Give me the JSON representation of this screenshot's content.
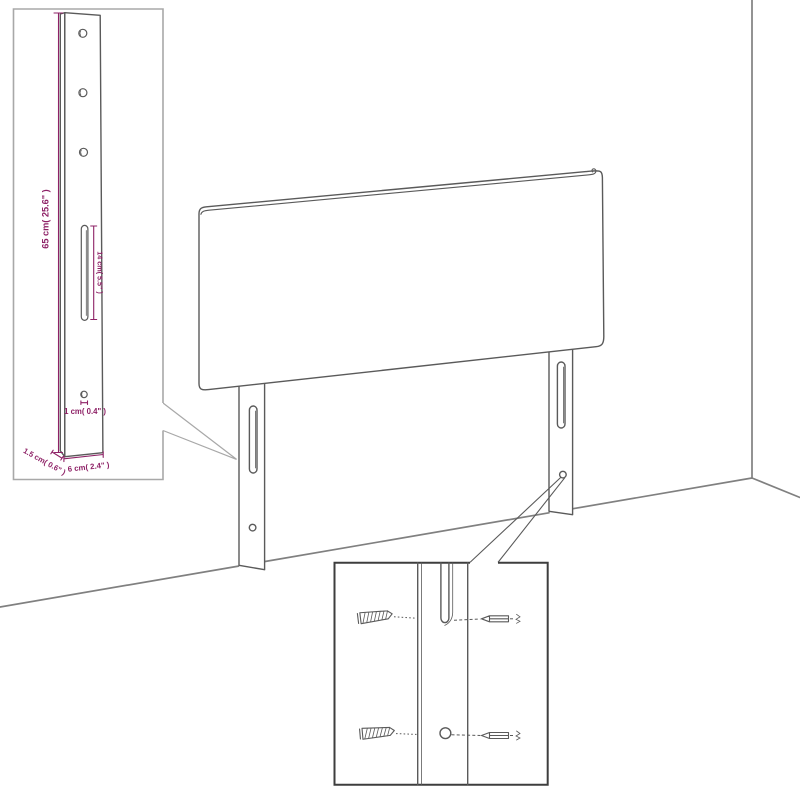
{
  "diagram": {
    "subject": "headboard-wall-mount-dimension-diagram",
    "colors": {
      "line": "#5a5a5a",
      "room_line": "#808080",
      "dimension_text": "#8e2166",
      "inset_detail_border": "#a8a8a8",
      "inset_screws_border": "#3e3e3e",
      "background": "#ffffff"
    },
    "dimension_labels": {
      "leg_height": "65 cm( 25.6\" )",
      "slot_length": "14 cm( 5.5\" )",
      "hole_diameter": "1 cm( 0.4\" )",
      "leg_depth": "1.5 cm( 0.6\" )",
      "leg_width": "6 cm( 2.4\" )"
    },
    "icons": {
      "screw_threaded": "screw-threaded-icon",
      "screw_plain": "screw-plain-icon",
      "mounting_slot": "mounting-slot",
      "screw_hole": "screw-hole"
    },
    "insets": {
      "leg_detail": "enlarged mounting leg with dimensions",
      "screw_detail": "enlarged slot and hole with wall screws"
    }
  }
}
